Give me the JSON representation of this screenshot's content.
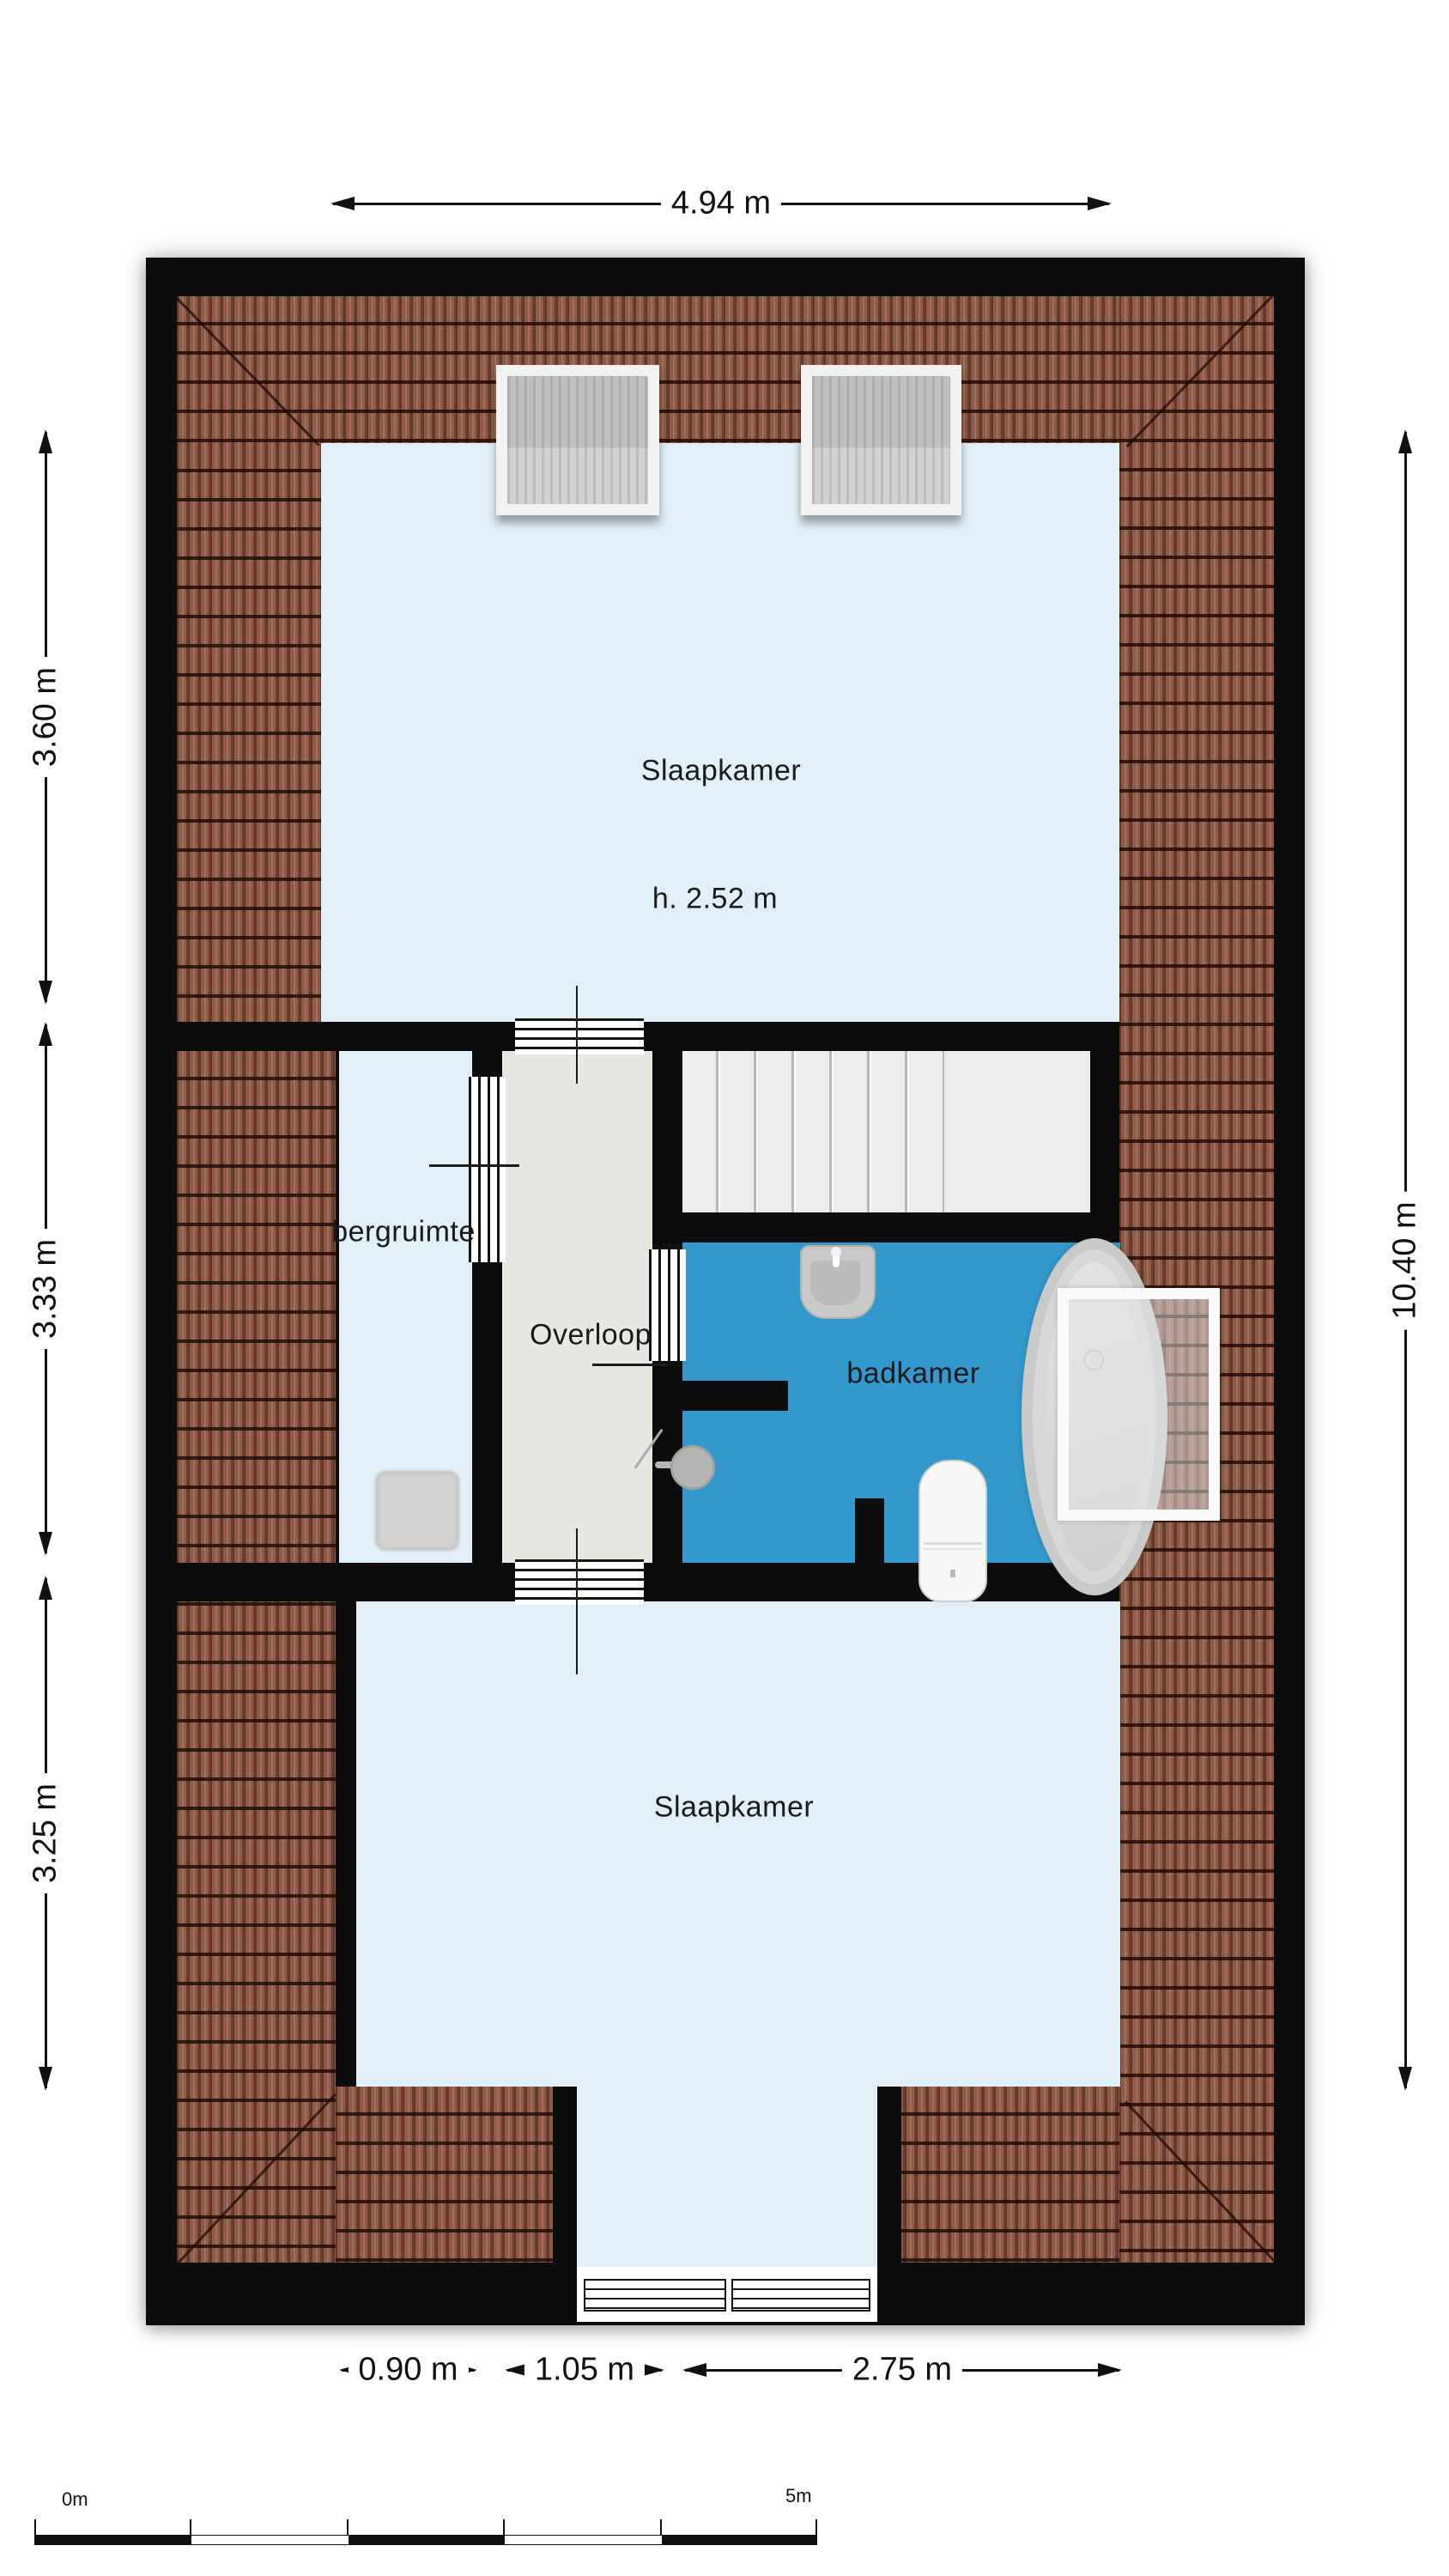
{
  "rooms": {
    "bedroom_top": {
      "name": "Slaapkamer",
      "ceiling_height": "h. 2.52 m"
    },
    "storage": {
      "name": "bergruimte"
    },
    "landing": {
      "name": "Overloop"
    },
    "bathroom": {
      "name": "badkamer"
    },
    "bedroom_bottom": {
      "name": "Slaapkamer"
    }
  },
  "dimensions": {
    "top": "4.94 m",
    "left": [
      "3.60 m",
      "3.33 m",
      "3.25 m"
    ],
    "right": "10.40 m",
    "bottom": [
      "0.90 m",
      "1.05 m",
      "2.75 m"
    ]
  },
  "scale_bar": {
    "start": "0m",
    "end": "5m",
    "segments": 5
  },
  "fixtures": [
    "skylight-window",
    "skylight-window",
    "staircase",
    "storage-closet",
    "washbasin",
    "shower",
    "toilet",
    "bathtub",
    "glass-screen",
    "dormer-window",
    "dormer-window"
  ],
  "colors": {
    "wall": "#0d0d0d",
    "room_blue": "#e1f0f8",
    "bathroom_blue": "#3399cd",
    "corridor_gray": "#e9e7e2",
    "stairs_gray": "#ededeb",
    "roof_brown": "#8f5a46",
    "fixture_gray": "#c9c9c7"
  }
}
